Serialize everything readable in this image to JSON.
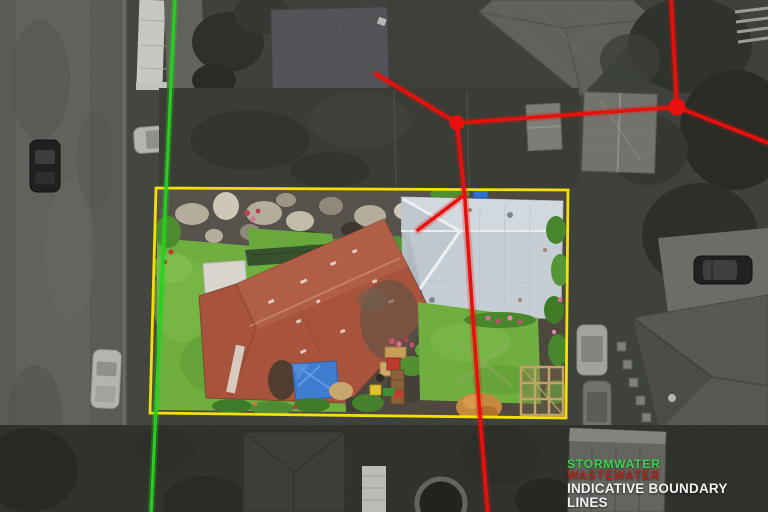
{
  "legend": {
    "stormwater_label": "STORMWATER",
    "wastewater_label": "WASTEWATER",
    "boundary_label": "INDICATIVE BOUNDARY LINES"
  },
  "colors": {
    "stormwater": "#25d11f",
    "wastewater": "#e8100c",
    "wastewater_legend": "#b3251a",
    "boundary": "#f5e003",
    "legend_text": "#f2f2f2"
  }
}
